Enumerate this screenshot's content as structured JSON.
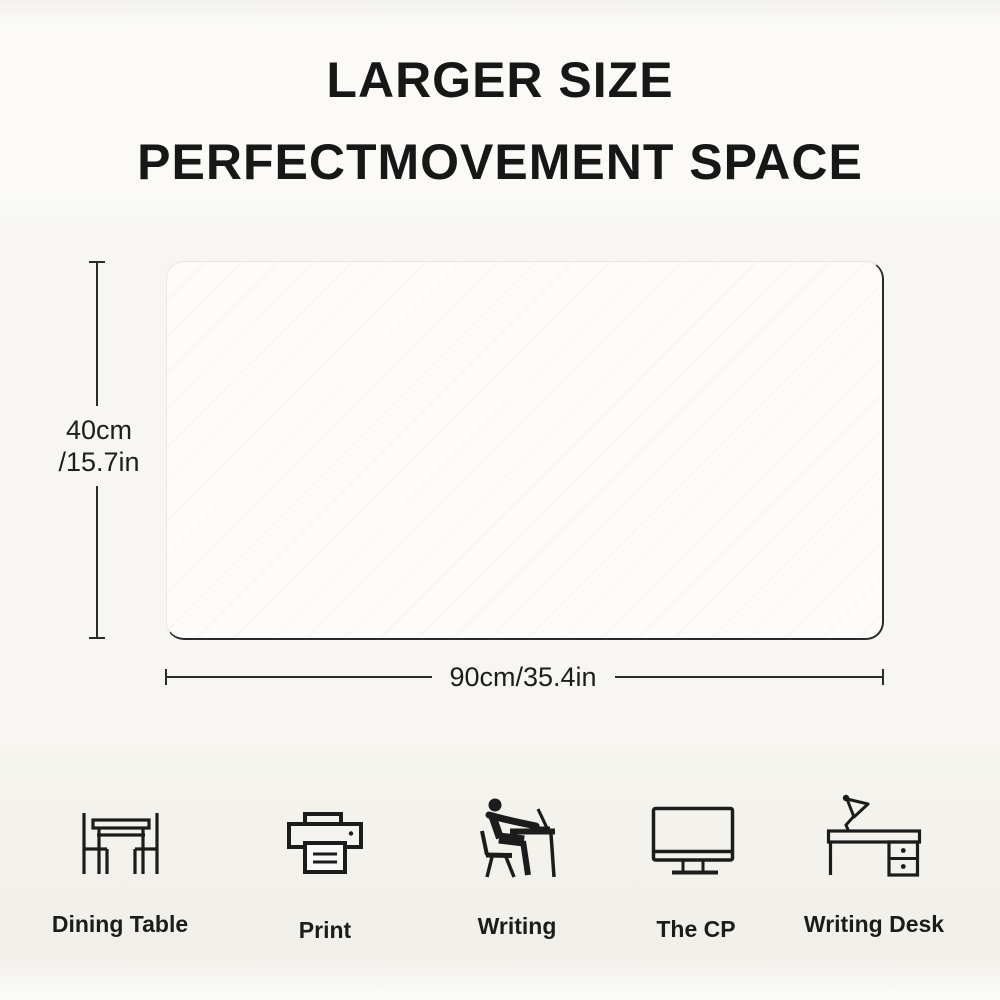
{
  "title": {
    "line1": "LARGER SIZE",
    "line2": "PERFECTMOVEMENT SPACE"
  },
  "mat_dimensions": {
    "height_line1": "40cm",
    "height_line2": "/15.7in",
    "width": "90cm/35.4in"
  },
  "use_cases": [
    {
      "label": "Dining Table",
      "icon": "dining-table-icon"
    },
    {
      "label": "Print",
      "icon": "printer-icon"
    },
    {
      "label": "Writing",
      "icon": "writing-person-icon"
    },
    {
      "label": "The CP",
      "icon": "computer-monitor-icon"
    },
    {
      "label": "Writing Desk",
      "icon": "writing-desk-icon"
    }
  ],
  "colors": {
    "ink": "#1c1c1c",
    "background": "#f6f5f1",
    "title_band": "#fbfaf7",
    "mat_fill": "#fdfcfa"
  }
}
